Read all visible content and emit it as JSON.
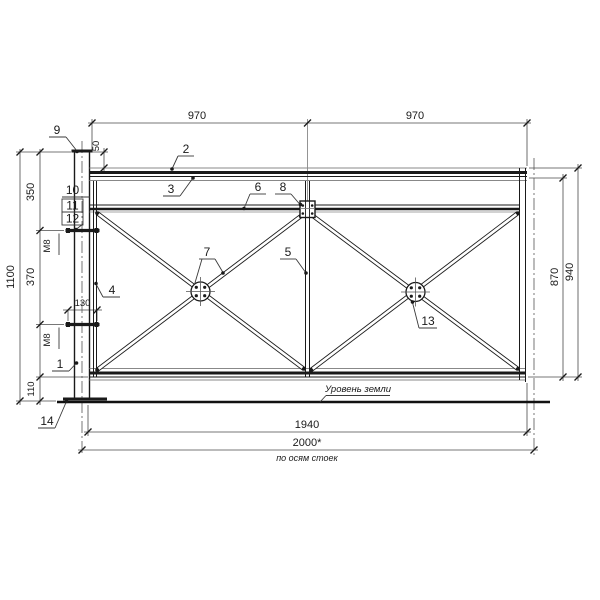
{
  "drawing": {
    "dims": {
      "bay_left": "970",
      "bay_right": "970",
      "top_offset": "50",
      "post_seg_350": "350",
      "post_seg_370": "370",
      "clamp_width": "130",
      "ground_clearance": "110",
      "post_height": "1100",
      "panel_inner_height": "870",
      "panel_height": "940",
      "frame_width": "1940",
      "axis_span": "2000*"
    },
    "notes": {
      "axis_note": "по осям стоек",
      "ground_label": "Уровень земли"
    },
    "bolts": {
      "upper": "М8",
      "lower": "М8"
    },
    "callouts": {
      "item1": "1",
      "item2": "2",
      "item3": "3",
      "item4": "4",
      "item5": "5",
      "item6": "6",
      "item7": "7",
      "item8": "8",
      "item9": "9",
      "item10": "10",
      "item11": "11",
      "item12": "12",
      "item13": "13",
      "item14": "14"
    }
  }
}
